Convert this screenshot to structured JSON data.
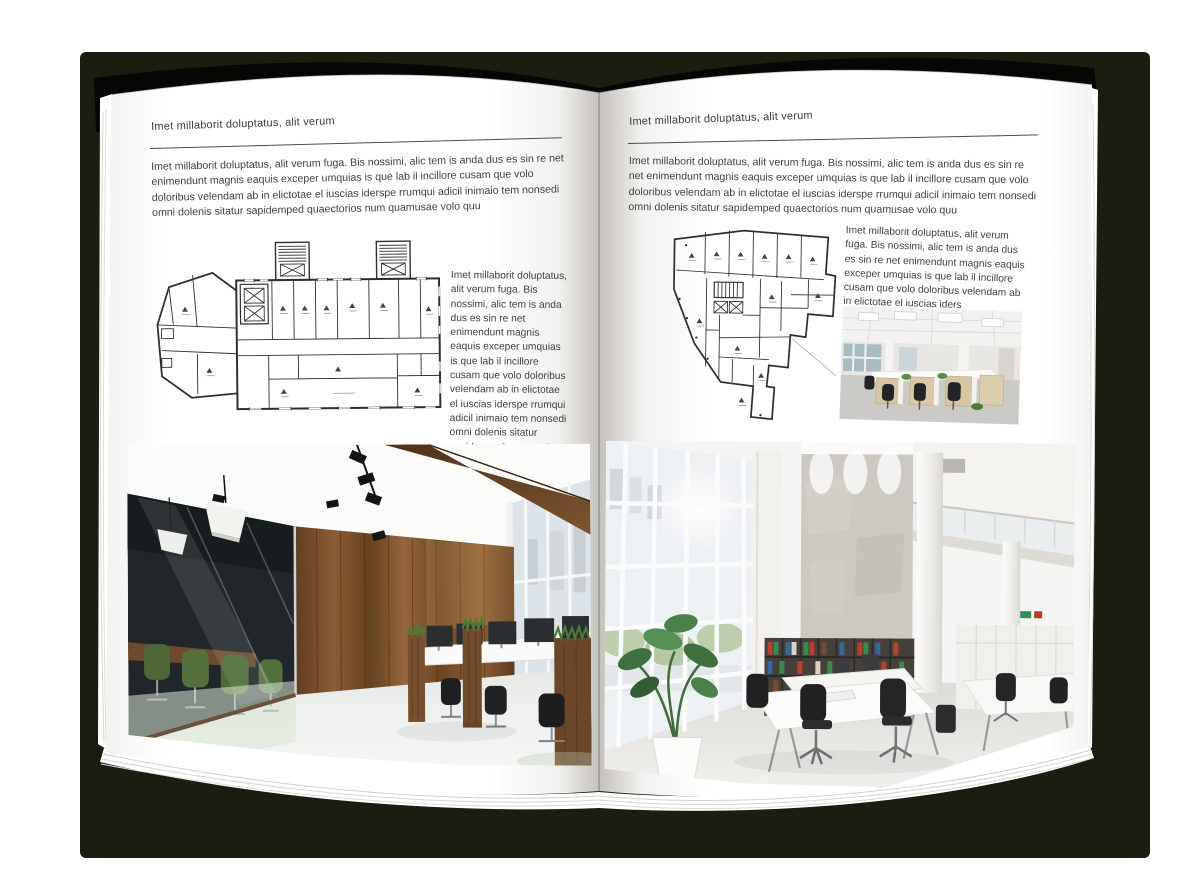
{
  "mockup": {
    "kind": "open-magazine-spread-mockup",
    "backdrop_color": "#1c1d11",
    "cover_color": "#060604",
    "page_color": "#ffffff",
    "text_color": "#404040",
    "rule_color": "#4c4c4c",
    "plan_line_color": "#2e2e2e",
    "wood_accent": "#7b5232",
    "plant_green": "#4e7a36"
  },
  "pages": [
    {
      "id": "left",
      "header": "Imet millaborit doluptatus, alit verum",
      "intro": "Imet millaborit doluptatus, alit verum fuga. Bis nossimi, alic tem is anda dus es sin re net enimendunt magnis eaquis exceper umquias is que lab il incillore cusam que volo doloribus velendam ab in elictotae el iuscias iderspe rrumqui adicil inimaio tem nonsedi omni dolenis sitatur sapidemped quaectorios num quamusae volo quu",
      "side_text": "Imet millaborit doluptatus, alit verum fuga. Bis nossimi, alic tem is anda dus es sin re net enimendunt magnis eaquis exceper umquias is que lab il incillore cusam que volo doloribus velendam ab in elictotae el iuscias iderspe rrumqui adicil inimaio tem nonsedi omni dolenis sitatur sapidemped quaectorios num quamusae volo quu",
      "floorplan_name": "wide-building-floor-plan",
      "photo_name": "office-interior-wood-panels-glass-meeting-room"
    },
    {
      "id": "right",
      "header": "Imet millaborit doluptatus, alit verum",
      "intro": "Imet millaborit doluptatus, alit verum fuga. Bis nossimi, alic tem is anda dus es sin re net enimendunt magnis eaquis exceper umquias is que lab il incillore cusam que volo doloribus velendam ab in elictotae el iuscias iderspe rrumqui adicil inimaio tem nonsedi omni dolenis sitatur sapidemped quaectorios num quamusae volo quu",
      "side_text": "Imet millaborit doluptatus, alit verum fuga. Bis nossimi, alic tem is anda dus es sin re net enimendunt magnis eaquis exceper umquias is que lab il incillore cusam que volo doloribus velendam ab in elictotae el iuscias iders",
      "floorplan_name": "tall-irregular-floor-plan",
      "photo_small_name": "bright-open-office-workstations",
      "photo_name": "double-height-white-office-bookshelves"
    }
  ]
}
